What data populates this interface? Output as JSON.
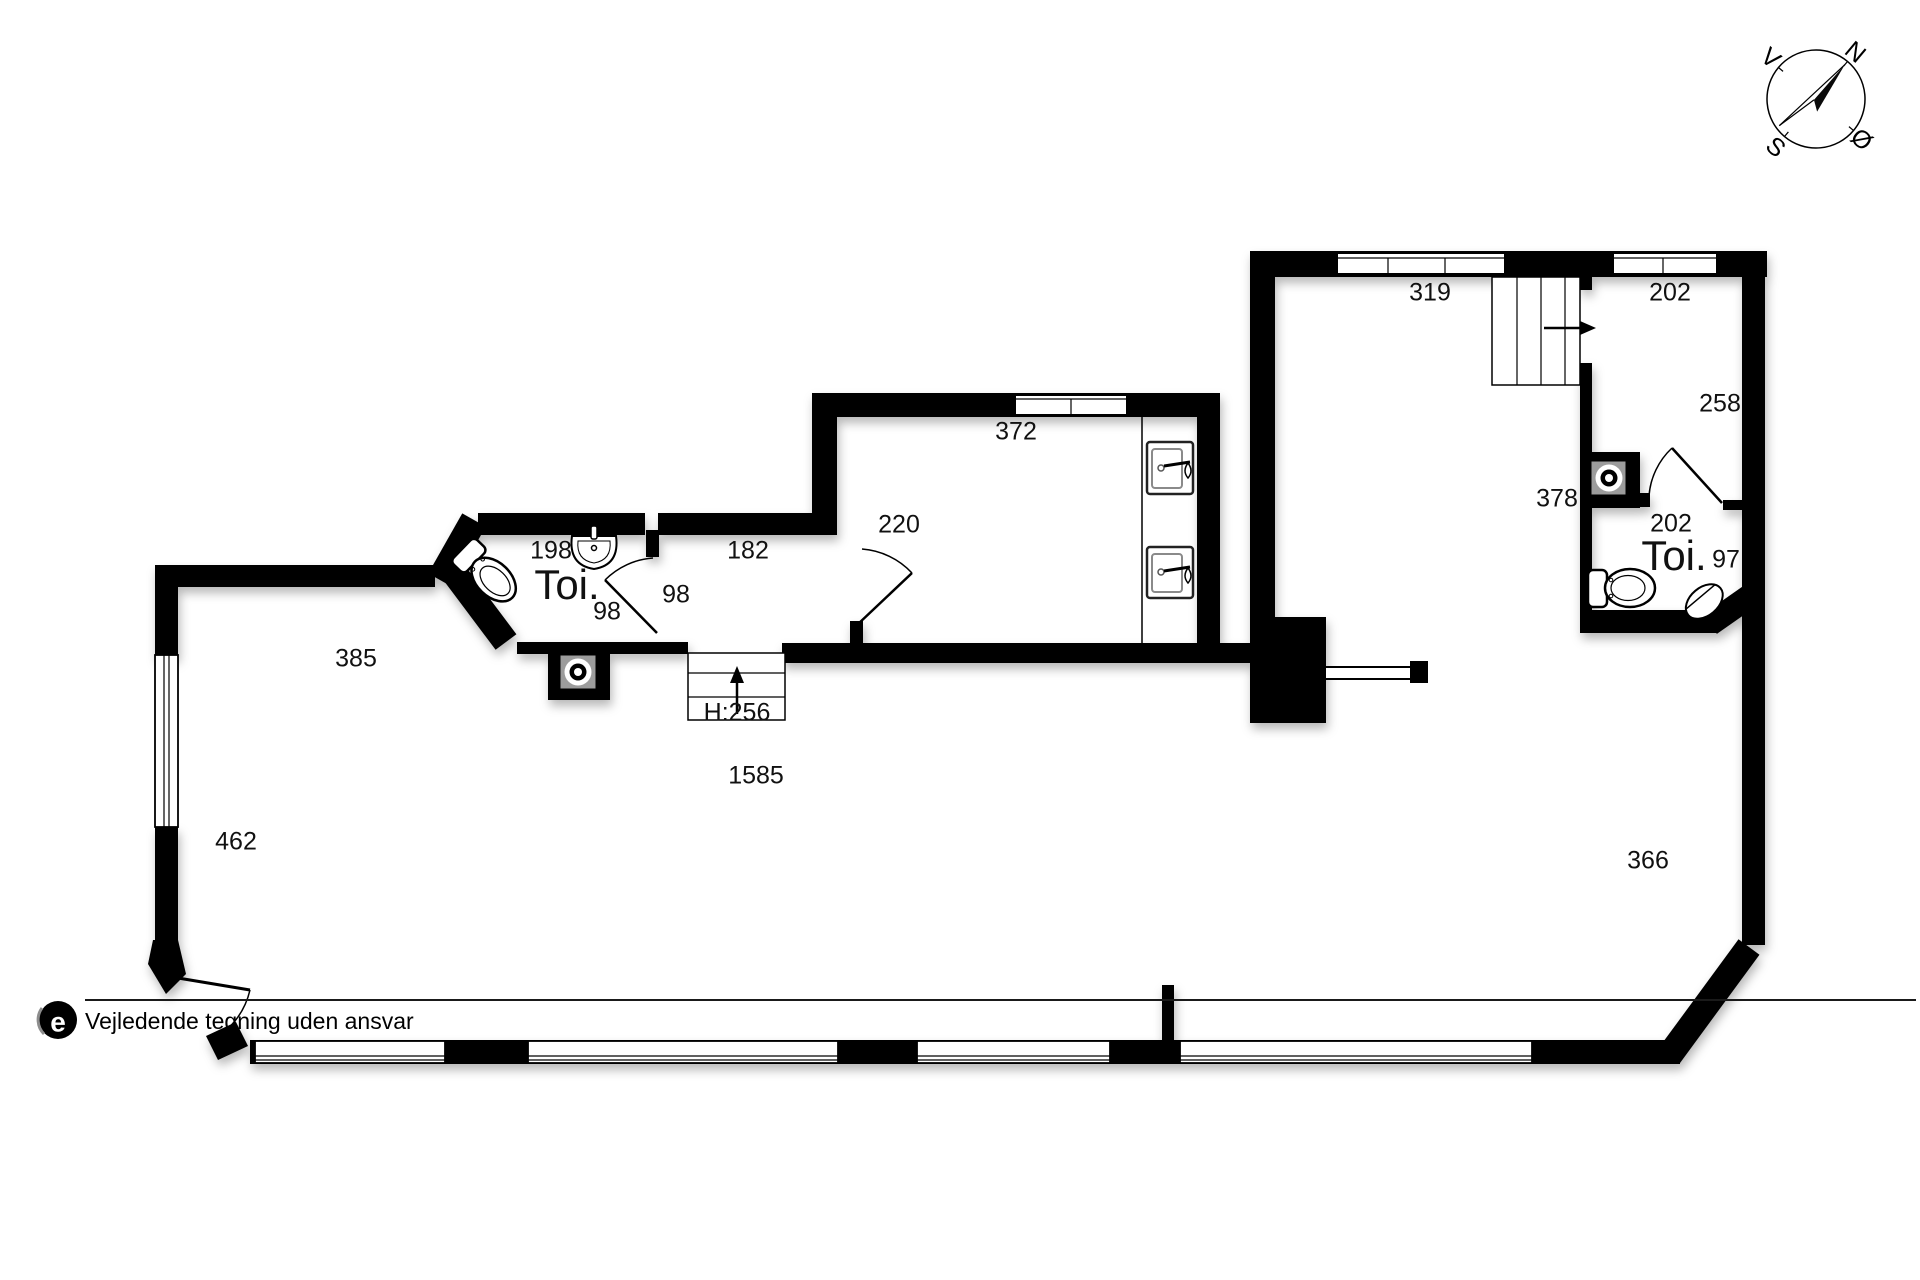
{
  "labels": [
    {
      "name": "dim-319",
      "text": "319"
    },
    {
      "name": "dim-202-top",
      "text": "202"
    },
    {
      "name": "dim-258",
      "text": "258"
    },
    {
      "name": "dim-378",
      "text": "378"
    },
    {
      "name": "dim-202-toilet",
      "text": "202"
    },
    {
      "name": "room-toi-right",
      "text": "Toi."
    },
    {
      "name": "dim-97",
      "text": "97"
    },
    {
      "name": "dim-372",
      "text": "372"
    },
    {
      "name": "dim-220",
      "text": "220"
    },
    {
      "name": "dim-182",
      "text": "182"
    },
    {
      "name": "dim-198",
      "text": "198"
    },
    {
      "name": "room-toi-left",
      "text": "Toi."
    },
    {
      "name": "dim-98-left",
      "text": "98"
    },
    {
      "name": "dim-98-right",
      "text": "98"
    },
    {
      "name": "dim-385",
      "text": "385"
    },
    {
      "name": "dim-462",
      "text": "462"
    },
    {
      "name": "dim-h256",
      "text": "H:256"
    },
    {
      "name": "dim-1585",
      "text": "1585"
    },
    {
      "name": "dim-366",
      "text": "366"
    }
  ],
  "compass": {
    "north": "N",
    "east": "Ø",
    "south": "S",
    "west": "V"
  },
  "footer": {
    "note": "Vejledende tegning uden ansvar",
    "logo_letter": "e"
  },
  "colors": {
    "wall": "#000000",
    "fixture_gray": "#9c9c9c",
    "background": "#ffffff"
  }
}
